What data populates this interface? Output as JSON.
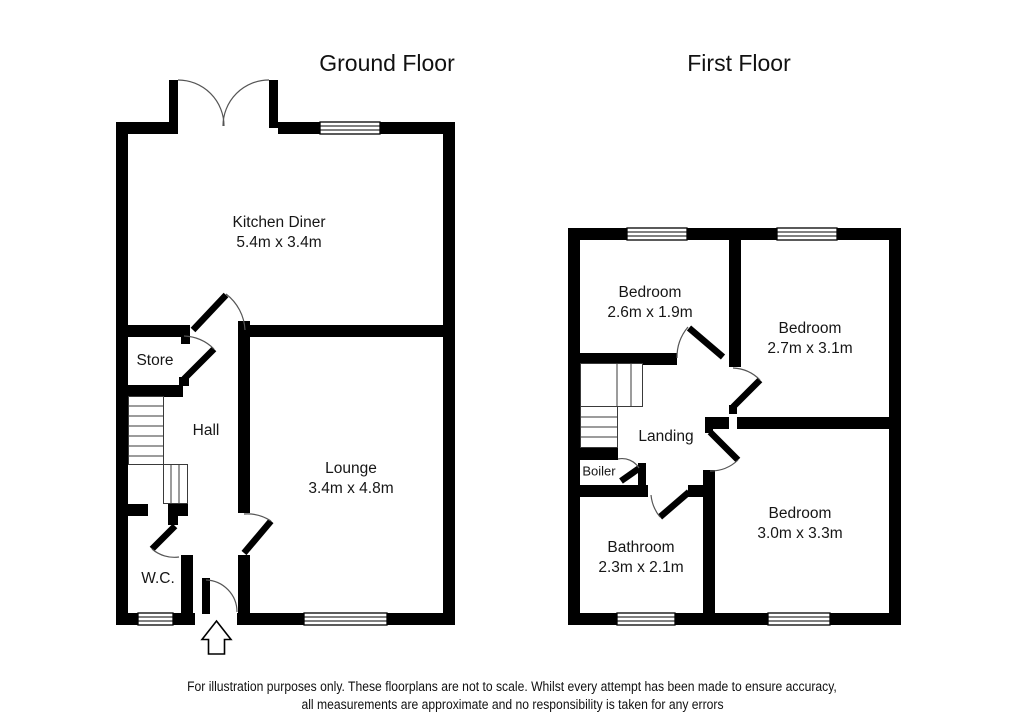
{
  "titles": {
    "ground_floor": "Ground Floor",
    "first_floor": "First Floor"
  },
  "ground_floor": {
    "rooms": [
      {
        "name": "Kitchen Diner",
        "dims": "5.4m x 3.4m"
      },
      {
        "name": "Store",
        "dims": ""
      },
      {
        "name": "Hall",
        "dims": ""
      },
      {
        "name": "Lounge",
        "dims": "3.4m x 4.8m"
      },
      {
        "name": "W.C.",
        "dims": ""
      }
    ]
  },
  "first_floor": {
    "rooms": [
      {
        "name": "Bedroom",
        "dims": "2.6m x 1.9m"
      },
      {
        "name": "Bedroom",
        "dims": "2.7m x 3.1m"
      },
      {
        "name": "Landing",
        "dims": ""
      },
      {
        "name": "Boiler",
        "dims": ""
      },
      {
        "name": "Bathroom",
        "dims": "2.3m x 2.1m"
      },
      {
        "name": "Bedroom",
        "dims": "3.0m x 3.3m"
      }
    ]
  },
  "footer": {
    "line1": "For illustration purposes only. These floorplans are not to scale. Whilst every attempt has been made to ensure accuracy,",
    "line2": "all measurements are approximate and no responsibility is taken for any errors"
  },
  "icons": {
    "entrance_arrow": "up-arrow-entrance-marker"
  },
  "colors": {
    "background": "#ffffff",
    "wall": "#000000",
    "door_arc": "#555555",
    "text": "#1a1a1a"
  }
}
